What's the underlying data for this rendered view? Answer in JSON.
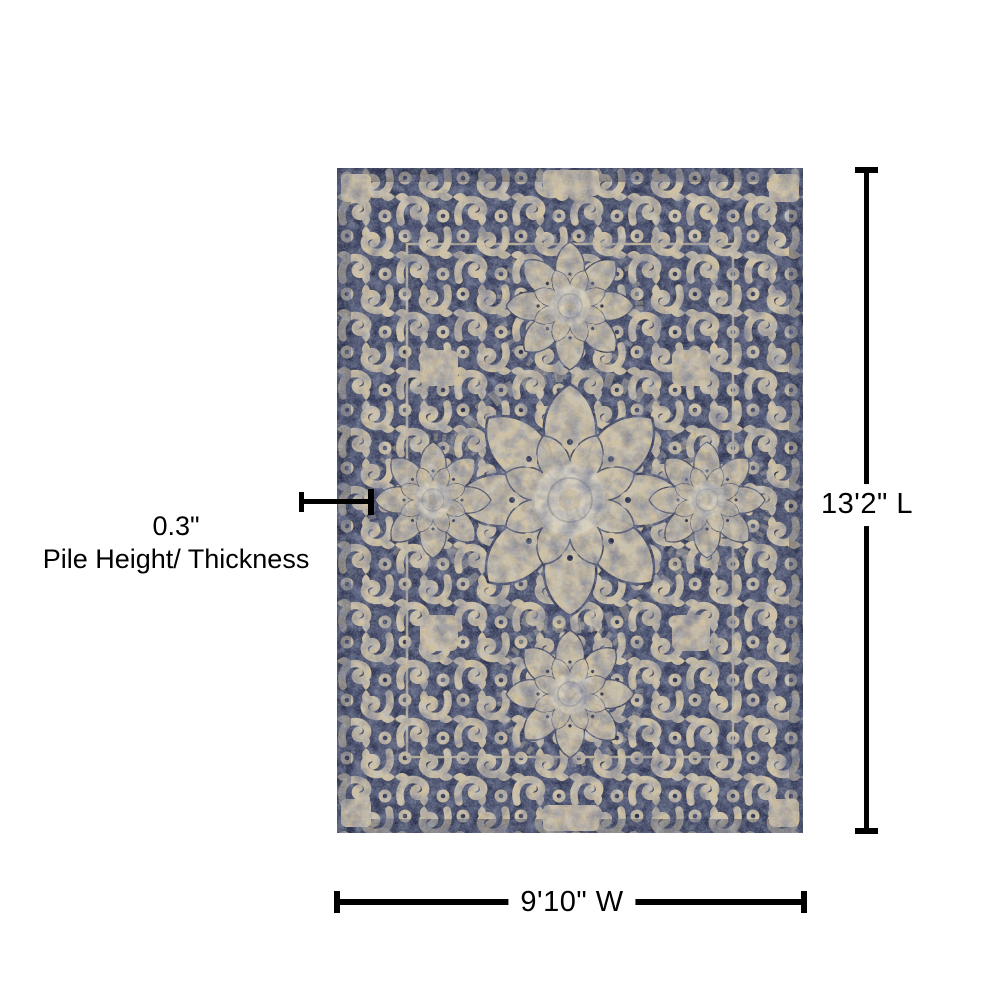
{
  "colors": {
    "page_bg": "#ffffff",
    "line_color": "#000000",
    "text_color": "#000000",
    "rug_navy": "#2e3554",
    "rug_navy_dark": "#1f2541",
    "rug_beige": "#cdbe9e",
    "rug_beige_light": "#d9cfb8",
    "rug_steel_blue": "#7d8aa8"
  },
  "diagram": {
    "dimensions": {
      "length": {
        "label": "13'2\" L"
      },
      "width": {
        "label": "9'10\" W"
      },
      "pile": {
        "value": "0.3\"",
        "caption": "Pile Height/ Thickness"
      }
    }
  }
}
